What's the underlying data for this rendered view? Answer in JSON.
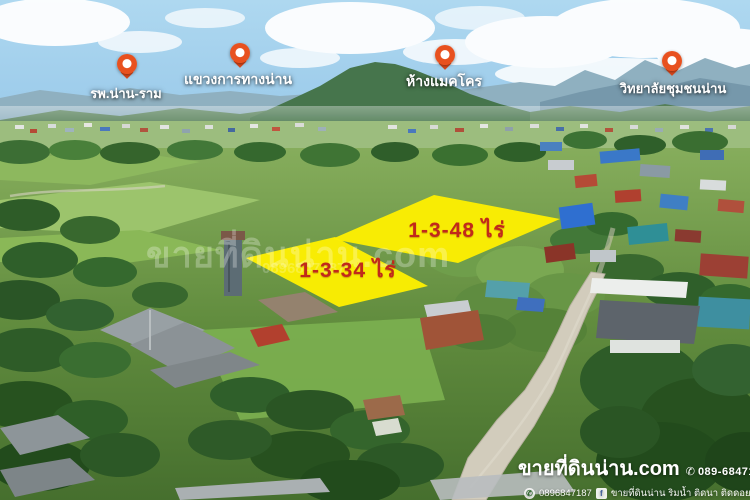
{
  "pins": [
    {
      "id": "hospital",
      "label": "รพ.น่าน-ราม"
    },
    {
      "id": "highway-district",
      "label": "แขวงการทางน่าน"
    },
    {
      "id": "makro",
      "label": "ห้างแมคโคร"
    },
    {
      "id": "community-college",
      "label": "วิทยาลัยชุมชนน่าน"
    }
  ],
  "plots": [
    {
      "id": "plot-48",
      "area_label": "1-3-48 ไร่"
    },
    {
      "id": "plot-34",
      "area_label": "1-3-34 ไร่"
    }
  ],
  "watermark": {
    "line1": "ขายที่ดินน่าน.com",
    "line2": "0896847187"
  },
  "contact": {
    "website": "ขายที่ดินน่าน.com",
    "phone_icon": "✆",
    "phone": "089-6847187",
    "line_icon": "✆",
    "line_id": "0896847187",
    "facebook_icon": "f",
    "facebook_page": "ขายที่ดินน่าน ริมน้ำ ติดนา ติดดอย"
  },
  "colors": {
    "plot_fill": "#fff000",
    "plot_text": "#c1291b",
    "pin_orange": "#e8511f",
    "contact_text": "#ffffff"
  },
  "icons": [
    "map-pin-icon",
    "phone-icon",
    "line-icon",
    "facebook-icon"
  ]
}
